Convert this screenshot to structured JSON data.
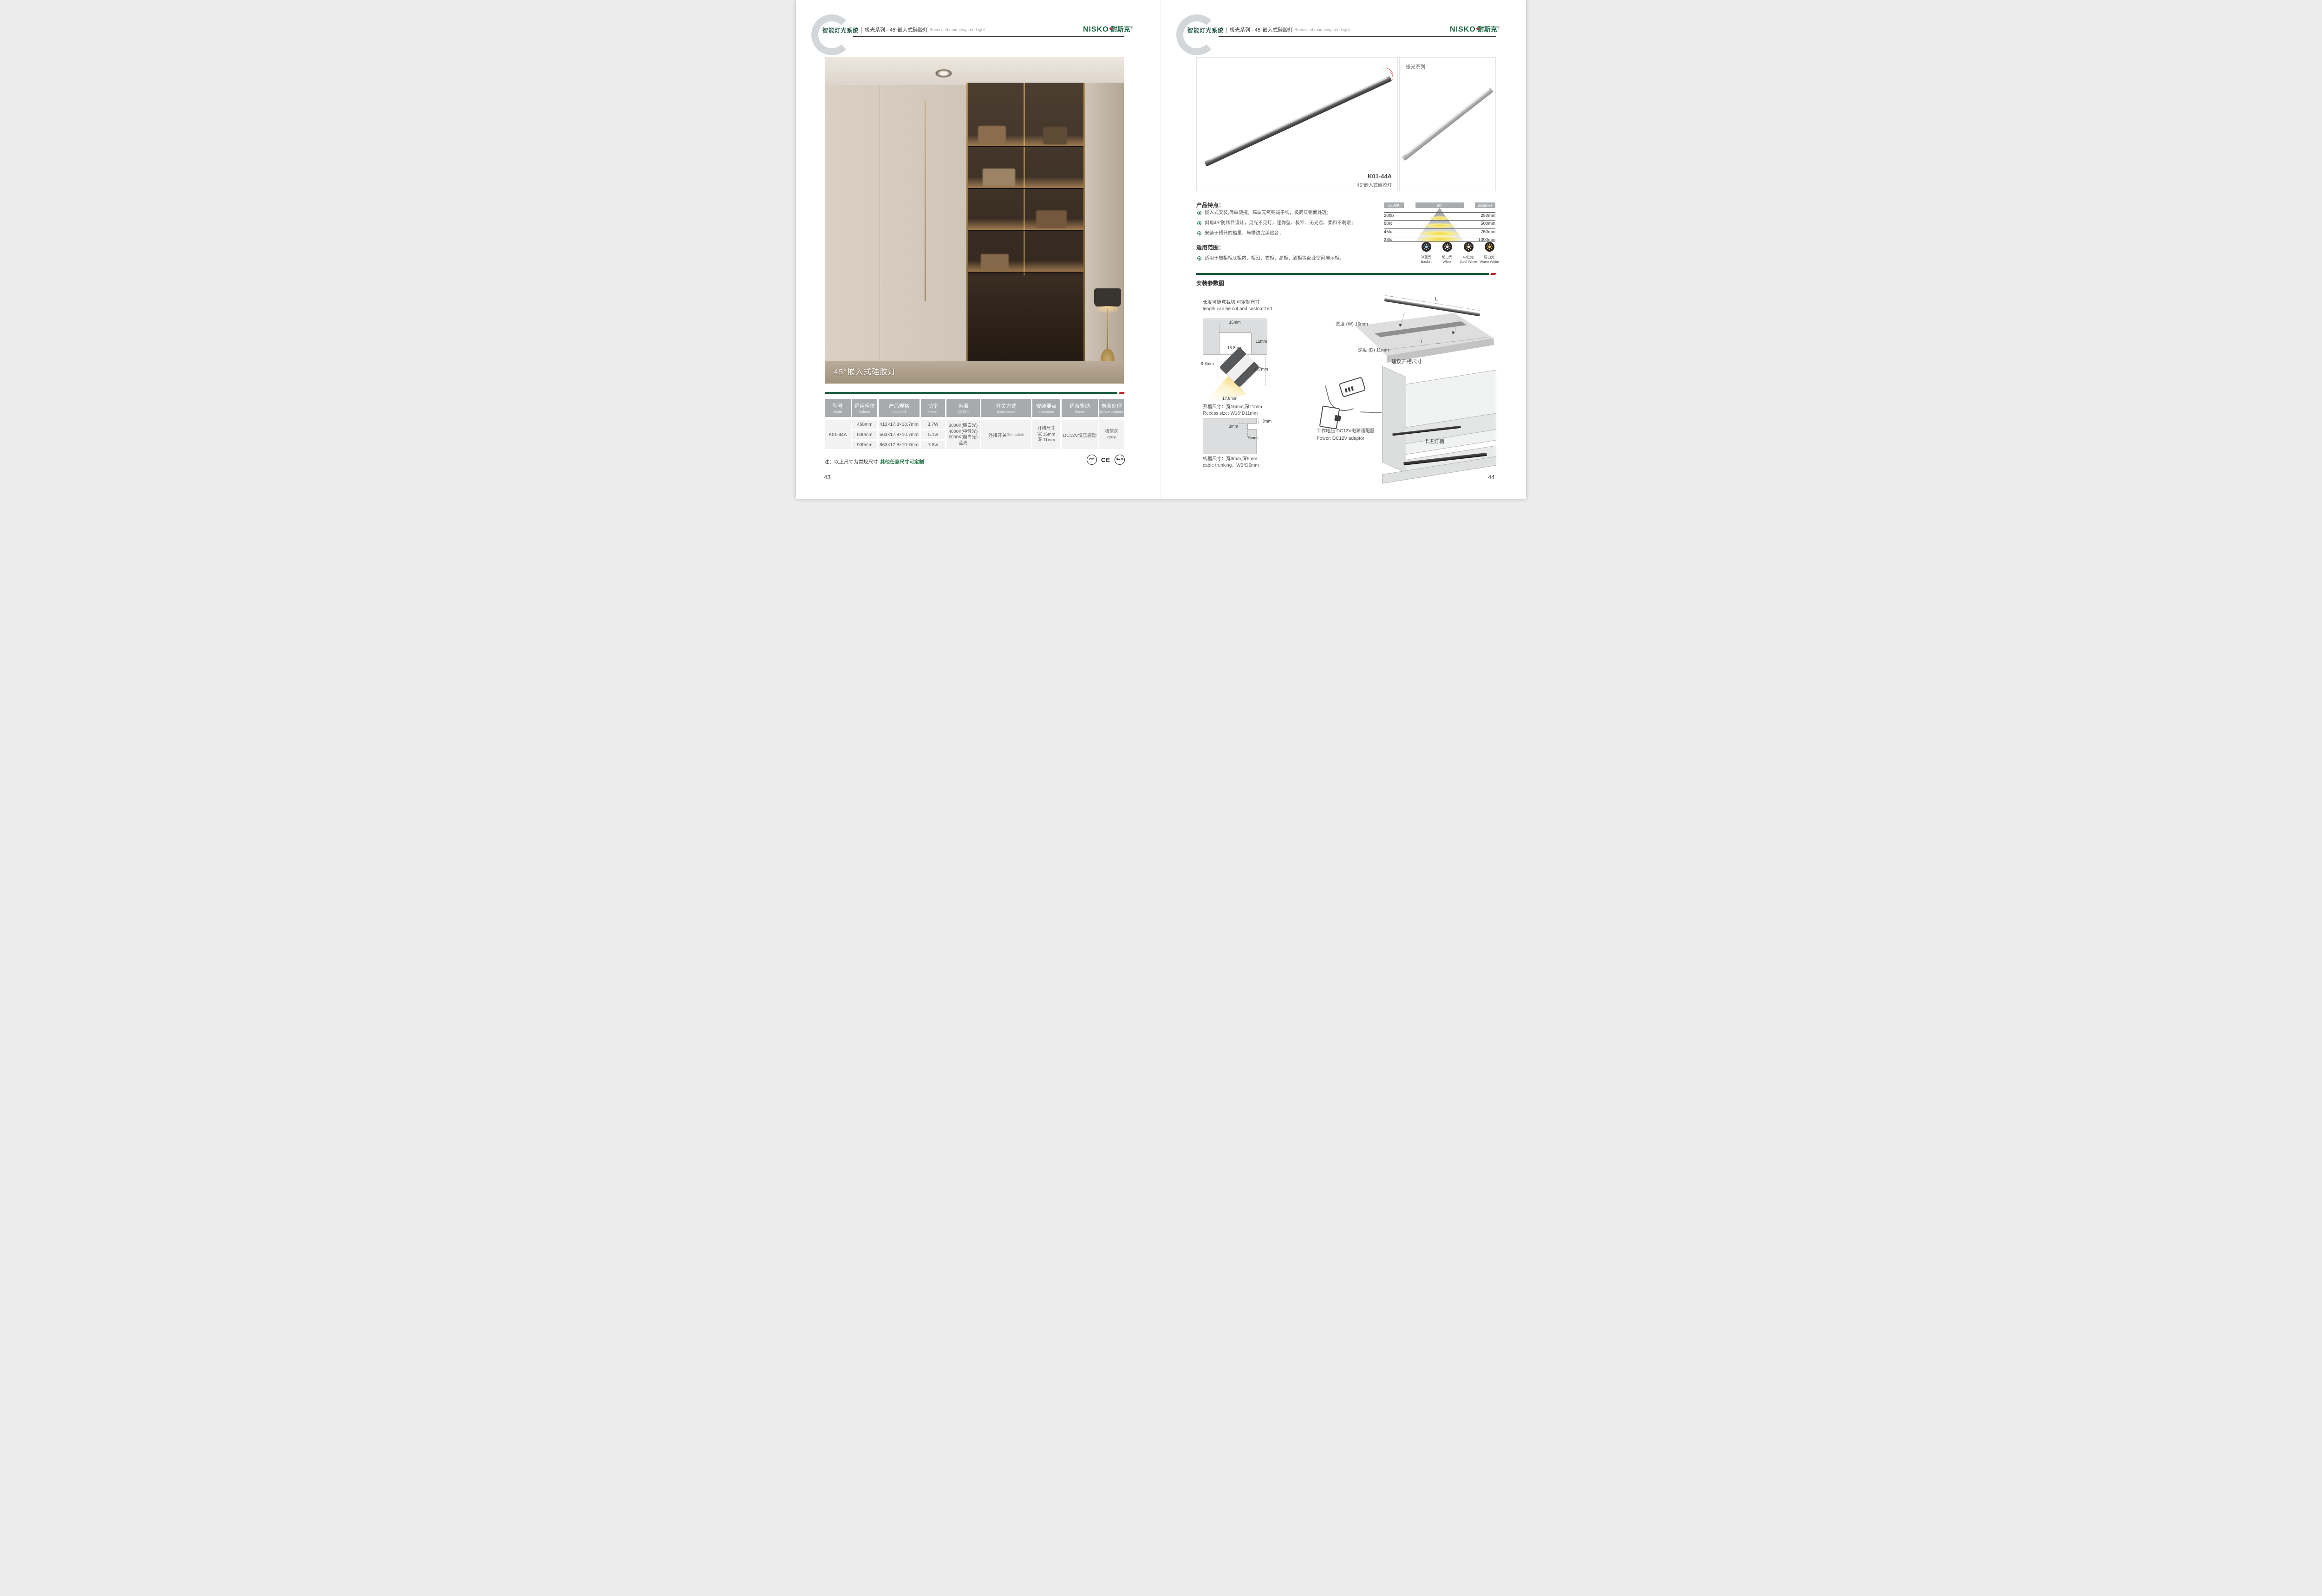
{
  "colors": {
    "brand_green": "#17613f",
    "dark_green_bar": "#1b5a3e",
    "accent_red": "#c0272d",
    "table_header_gray": "#a8abad",
    "note_green": "#2a7a4b"
  },
  "header": {
    "system_title": "智能灯光系统",
    "series_title": "极光系列 · 45°嵌入式硅胶灯",
    "series_en": "Recessed mounting Led Light"
  },
  "brand": {
    "latin": "NISKO",
    "cn": "耐斯克",
    "reg": "®"
  },
  "left": {
    "photo_caption": "45°嵌入式硅胶灯",
    "table": {
      "headers": [
        {
          "zh": "型号",
          "en": "Model"
        },
        {
          "zh": "适用柜体",
          "en": "Cabinet"
        },
        {
          "zh": "产品规格",
          "en": "L x D x H"
        },
        {
          "zh": "功率",
          "en": "Power"
        },
        {
          "zh": "色温",
          "en": "CCT(K)"
        },
        {
          "zh": "开关方式",
          "en": "Switch mode"
        },
        {
          "zh": "安装要点",
          "en": "Installation"
        },
        {
          "zh": "适合驱动",
          "en": "Power"
        },
        {
          "zh": "表面处理",
          "en": "Surface treatment"
        }
      ],
      "model": "K01-44A",
      "rows": [
        {
          "cabinet": "450mm",
          "size": "413×17.8×10.7mm",
          "power": "3.7W"
        },
        {
          "cabinet": "600mm",
          "size": "563×17.8×10.7mm",
          "power": "5.1w"
        },
        {
          "cabinet": "900mm",
          "size": "863×17.8×10.7mm",
          "power": "7.8w"
        }
      ],
      "cct_lines": [
        "3000K(暖白光)",
        "4000K(中性光)",
        "6000K(超白光)",
        "蓝光"
      ],
      "switch_zh": "外接开关",
      "switch_en": "/No switch",
      "install_lines": [
        "开槽尺寸",
        "宽 16mm",
        "深 11mm"
      ],
      "driver": "DC12V恒压驱动",
      "surface_lines": [
        "极简灰",
        "grey"
      ]
    },
    "note_black": "注：以上尺寸为常规尺寸",
    "note_green": "其他任意尺寸可定制",
    "certs": [
      "CCC",
      "CE",
      "RoHS"
    ],
    "page_no": "43"
  },
  "right": {
    "series_tag": "极光系列",
    "product_model": "K01-44A",
    "product_name": "45°嵌入式硅胶灯",
    "features_title": "产品特点：",
    "features": [
      "嵌入式安装,简单便捷，高端无氧铜端子线，极简灰铝面处理；",
      "斜角45°防炫目设计，见光不见灯，迷你型、极窄、无光点、柔和不刺眼；",
      "安装于预开的槽里，与槽边完美贴合；"
    ],
    "distribution": {
      "cct": "6500K",
      "angle": "90°",
      "distance_label": "distance",
      "rows": [
        {
          "lux": "200lx",
          "mm": "250mm"
        },
        {
          "lux": "88lx",
          "mm": "500mm"
        },
        {
          "lux": "45lx",
          "mm": "750mm"
        },
        {
          "lux": "33lx",
          "mm": "1000mm"
        }
      ]
    },
    "color_temps": [
      {
        "zh": "冰蓝光",
        "en": "Basket",
        "color": "#9fd4f0"
      },
      {
        "zh": "超白光",
        "en": "White",
        "color": "#ffffff"
      },
      {
        "zh": "中性光",
        "en": "Cool White",
        "color": "#f6ecd0"
      },
      {
        "zh": "暖白光",
        "en": "Warm White",
        "color": "#eec56a"
      }
    ],
    "app_title": "适用范围：",
    "app_item": "适用于橱柜柜底柜内、柜沿、衣柜、高柜、酒柜等商业空间展示柜。",
    "install": {
      "title": "安装参数图",
      "cut_zh": "长度可随意裁切,可定制尺寸",
      "cut_en": "length can be cut and customized",
      "recess_top": "16mm",
      "recess_side": "11mm",
      "recess_bottom": "15.8mm",
      "prof_left": "9.8mm",
      "prof_right": "10.7mm",
      "prof_bottom": "17.8mm",
      "recess_zh": "开槽尺寸：宽16mm,深11mm",
      "recess_en": "Recess size: W16*D11mm",
      "trunk_top": "3mm",
      "trunk_left": "3mm",
      "trunk_bottom": "5mm",
      "trunk_zh": "线槽尺寸：宽3mm,深5mm",
      "trunk_en": "cable trunking：W3*D5mm",
      "board_w": "宽度 (W) 16mm",
      "board_d": "深度 (D) 11mm",
      "board_l": "L",
      "board_caption": "建议开槽尺寸",
      "power_zh": "工作电压:DC12V电源适配器",
      "power_en": "Power: DC12V adaptor",
      "clip_label": "卡进灯槽"
    },
    "page_no": "44"
  }
}
